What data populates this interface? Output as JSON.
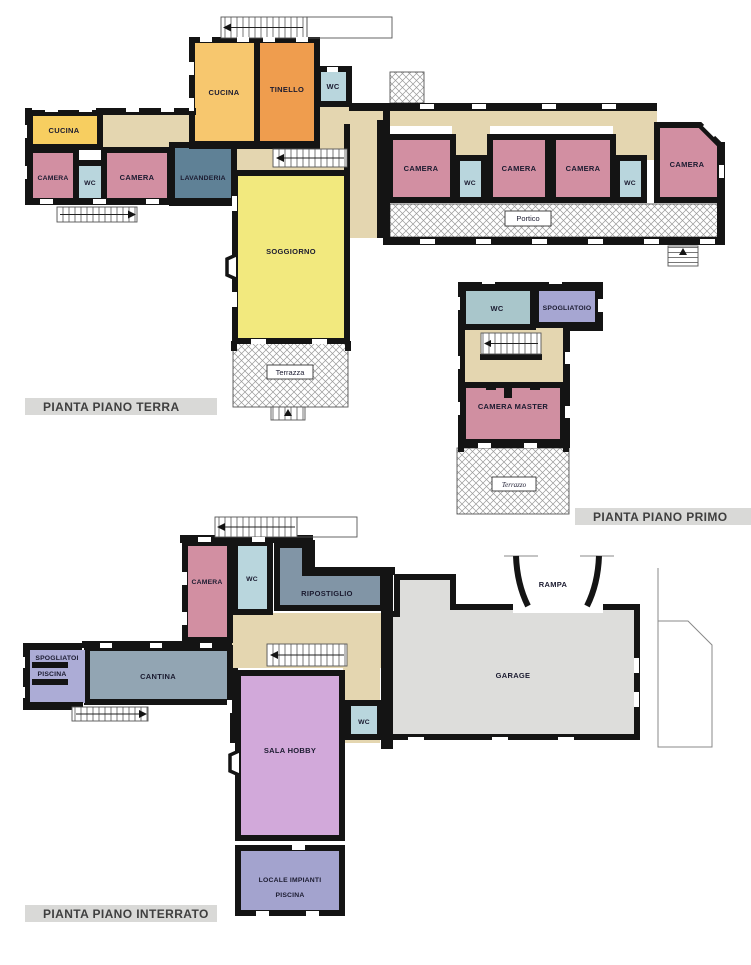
{
  "palette": {
    "camera": "#D28FA2",
    "wc": "#B9D6DD",
    "cucina": "#F7C76E",
    "cucina2": "#F7CE60",
    "tinello": "#EF9D4E",
    "lavanderia": "#5F8196",
    "soggiorno": "#F2E97E",
    "corridor": "#E4D6B0",
    "wc_primo": "#A9C6CB",
    "spogliatoio": "#A6A6D2",
    "camera_master": "#D08FA1",
    "ripostiglio": "#8195A6",
    "cantina": "#92A5B3",
    "spogliatoi_piscina": "#ACACD6",
    "garage": "#DDDDDB",
    "sala_hobby": "#D2A9DA",
    "locale_impianti": "#A3A3CE",
    "wall": "#141414",
    "caption_bg": "#D9D9D7",
    "caption_text": "#3F3F3F"
  },
  "captions": {
    "terra": "PIANTA PIANO TERRA",
    "primo": "PIANTA PIANO PRIMO",
    "interrato": "PIANTA PIANO INTERRATO"
  },
  "labels": {
    "cucina": "CUCINA",
    "tinello": "TINELLO",
    "wc": "WC",
    "camera": "CAMERA",
    "lavanderia": "LAVANDERIA",
    "soggiorno": "SOGGIORNO",
    "portico": "Portico",
    "terrazza": "Terrazza",
    "spogliatoio": "SPOGLIATOIO",
    "camera_master": "CAMERA MASTER",
    "terrazzo": "Terrazzo",
    "ripostiglio": "RIPOSTIGLIO",
    "spogliatoi": "SPOGLIATOI",
    "piscina": "PISCINA",
    "cantina": "CANTINA",
    "rampa": "RAMPA",
    "garage": "GARAGE",
    "sala_hobby": "SALA HOBBY",
    "locale_impianti": "LOCALE IMPIANTI"
  }
}
